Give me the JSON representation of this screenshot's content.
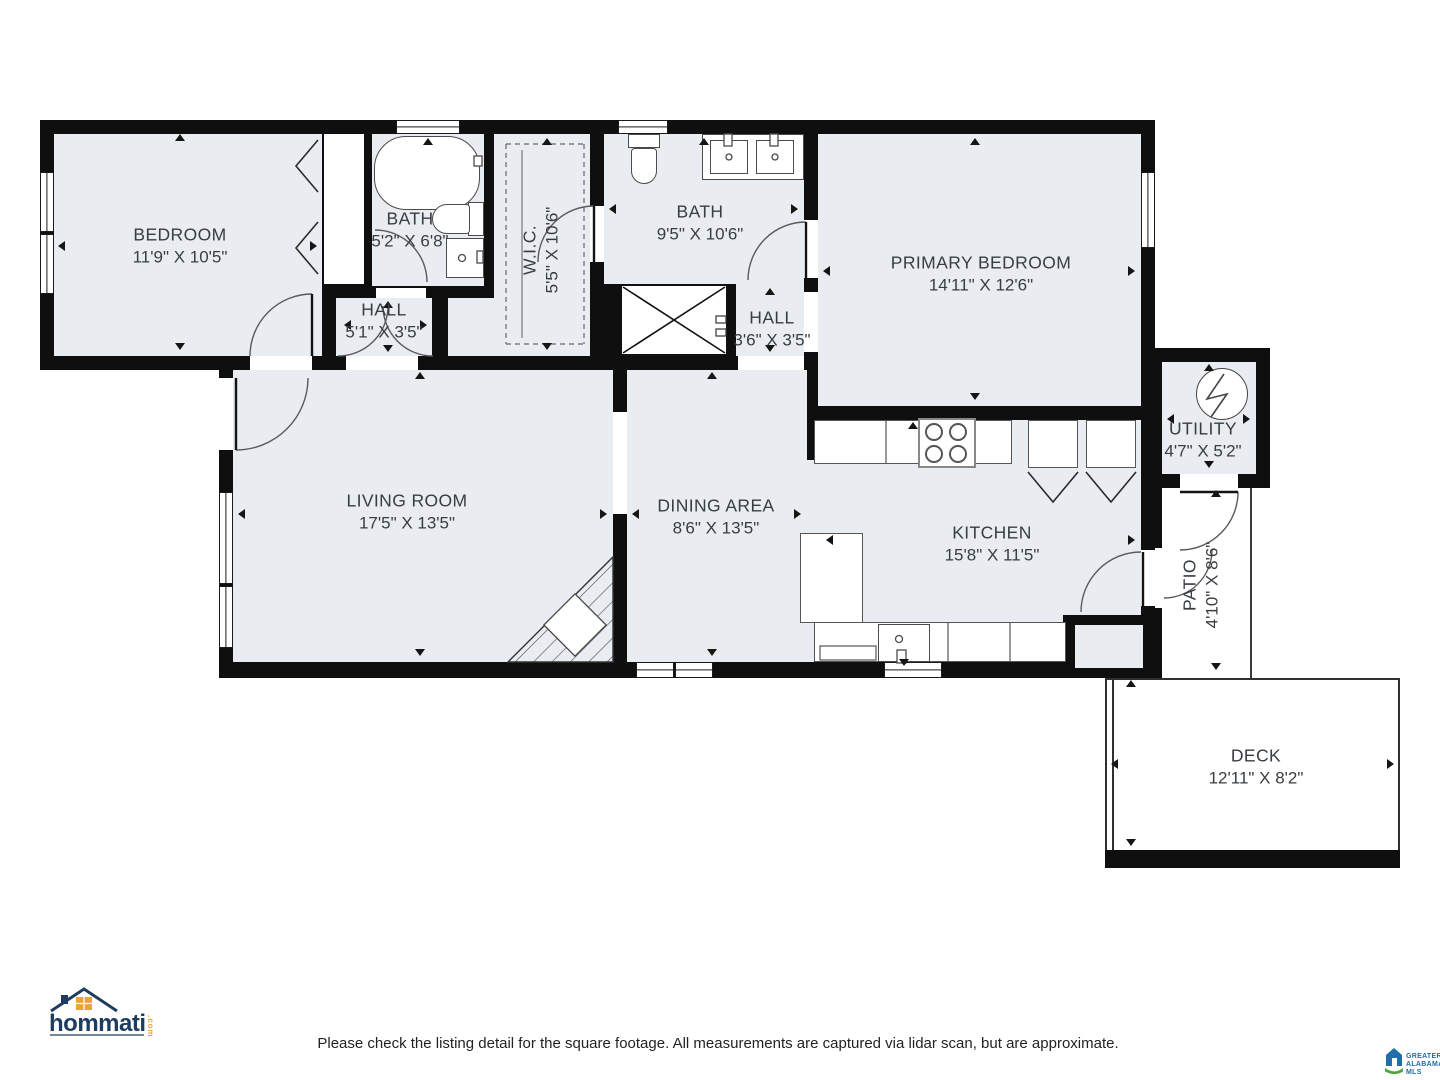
{
  "rooms": {
    "bedroom": {
      "name": "BEDROOM",
      "dims": "11'9\" X 10'5\""
    },
    "bath1": {
      "name": "BATH",
      "dims": "5'2\" X 6'8\""
    },
    "wic": {
      "name": "W.I.C.",
      "dims": "5'5\" X 10'6\""
    },
    "bath2": {
      "name": "BATH",
      "dims": "9'5\" X 10'6\""
    },
    "hall1": {
      "name": "HALL",
      "dims": "5'1\" X 3'5\""
    },
    "hall2": {
      "name": "HALL",
      "dims": "3'6\" X 3'5\""
    },
    "primary": {
      "name": "PRIMARY BEDROOM",
      "dims": "14'11\" X 12'6\""
    },
    "utility": {
      "name": "UTILITY",
      "dims": "4'7\" X 5'2\""
    },
    "living": {
      "name": "LIVING ROOM",
      "dims": "17'5\" X 13'5\""
    },
    "dining": {
      "name": "DINING AREA",
      "dims": "8'6\" X 13'5\""
    },
    "kitchen": {
      "name": "KITCHEN",
      "dims": "15'8\" X 11'5\""
    },
    "patio": {
      "name": "PATIO",
      "dims": "4'10\" X 8'6\""
    },
    "deck": {
      "name": "DECK",
      "dims": "12'11\" X 8'2\""
    }
  },
  "footer": {
    "disclaimer": "Please check the listing detail for the square footage. All measurements are captured via lidar scan, but are approximate."
  },
  "branding": {
    "hommati": {
      "text": "hommati",
      "tld": ".com"
    },
    "mls": {
      "line1": "GREATER",
      "line2": "ALABAMA",
      "line3": "MLS"
    }
  },
  "icons": {
    "water-heater": "circle-with-zigzag",
    "stove": "four-burner-cooktop",
    "shower": "crossed-box",
    "fireplace": "corner-hatched-triangle",
    "closet-doors": "bifold-chevrons"
  },
  "colors": {
    "wall": "#0f0f0f",
    "room_fill": "#e9edf1",
    "fixture_line": "#4a4a4a",
    "label_text": "#383d42",
    "hommati_navy": "#1d3c5f",
    "hommati_orange": "#e9a43c",
    "mls_blue": "#1f6fa8",
    "mls_green": "#55a53e"
  }
}
